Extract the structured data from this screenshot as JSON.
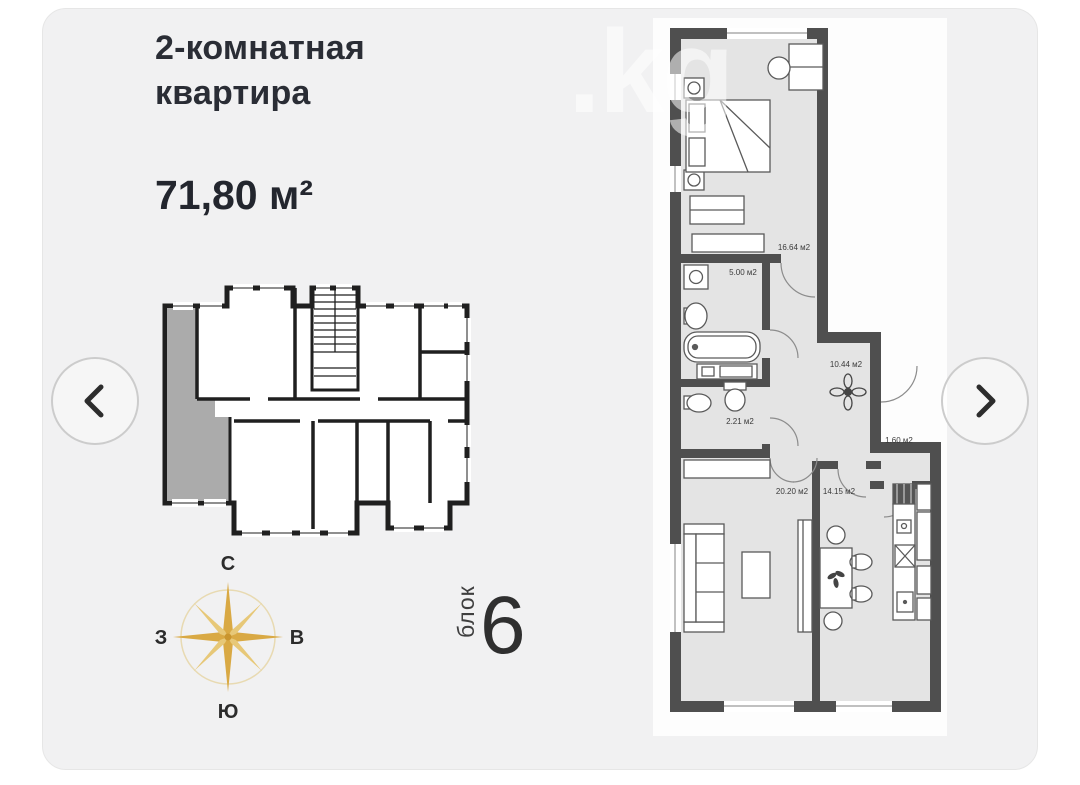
{
  "listing": {
    "type_line1": "2-комнатная",
    "type_line2": "квартира",
    "area_total": "71,80 м²"
  },
  "block": {
    "label": "блок",
    "number": "6"
  },
  "compass": {
    "north": "С",
    "south": "Ю",
    "west": "З",
    "east": "В"
  },
  "watermark": ".kg",
  "carousel": {
    "prev_icon": "chevron-left",
    "next_icon": "chevron-right"
  },
  "floorplan": {
    "highlight_color": "#ababab",
    "wall_color": "#4f4f4f",
    "rooms": [
      {
        "name": "bedroom",
        "area_label": "16.64 м2"
      },
      {
        "name": "bathroom",
        "area_label": "5.00 м2"
      },
      {
        "name": "hallway",
        "area_label": "10.44 м2"
      },
      {
        "name": "wc",
        "area_label": "2.21 м2"
      },
      {
        "name": "storage",
        "area_label": "1.60 м2"
      },
      {
        "name": "living-room",
        "area_label": "20.20 м2"
      },
      {
        "name": "kitchen",
        "area_label": "14.15 м2"
      }
    ]
  },
  "colors": {
    "compass_gold": "#d9a944",
    "compass_gold_light": "#e7c878"
  }
}
